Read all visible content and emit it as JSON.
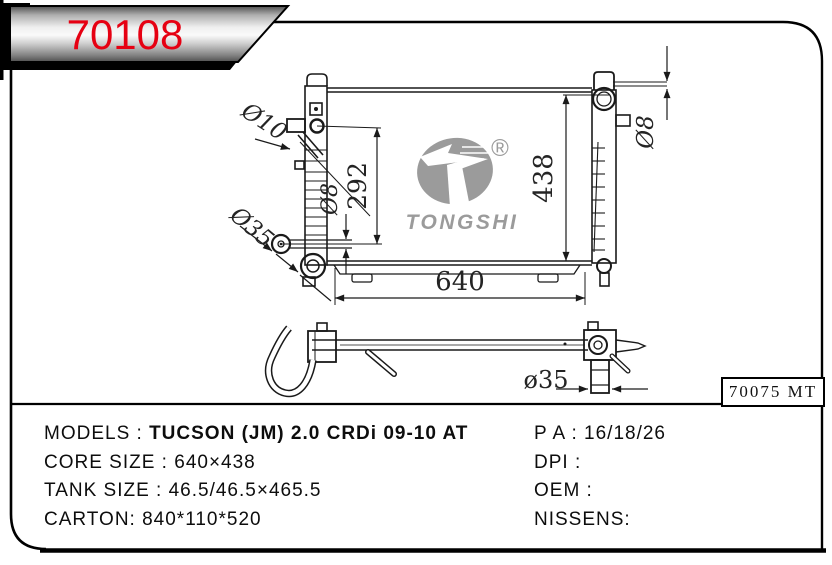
{
  "banner": {
    "part_number": "70108"
  },
  "ref_box": {
    "code": "70075 MT"
  },
  "specs": {
    "left": [
      {
        "label": "MODELS : ",
        "value": "TUCSON (JM) 2.0 CRDi 09-10 AT"
      },
      {
        "label": "CORE SIZE : ",
        "value": "640×438"
      },
      {
        "label": "TANK SIZE : ",
        "value": "46.5/46.5×465.5"
      },
      {
        "label": "CARTON: ",
        "value": "840*110*520"
      }
    ],
    "right": [
      {
        "label": "P A : ",
        "value": "16/18/26"
      },
      {
        "label": "DPI : ",
        "value": ""
      },
      {
        "label": "OEM : ",
        "value": ""
      },
      {
        "label": "NISSENS: ",
        "value": ""
      }
    ]
  },
  "drawing": {
    "front_view": {
      "labels": {
        "inlet_diameter": "Ø10",
        "inlet_outlet_distance": "292",
        "outlet_pipe_diameter": "Ø8",
        "outlet_diameter": "Ø35",
        "core_height": "438",
        "overflow_pipe_diameter": "Ø8",
        "core_width": "640"
      }
    },
    "side_view": {
      "labels": {
        "pipe_diameter": "ø35"
      }
    },
    "logo": {
      "brand": "TONGSHI",
      "registered_mark": "®"
    }
  },
  "colors": {
    "part_number_red": "#e60012",
    "logo_gray": "#9b9b9b",
    "line_black": "#1a1a1a"
  }
}
